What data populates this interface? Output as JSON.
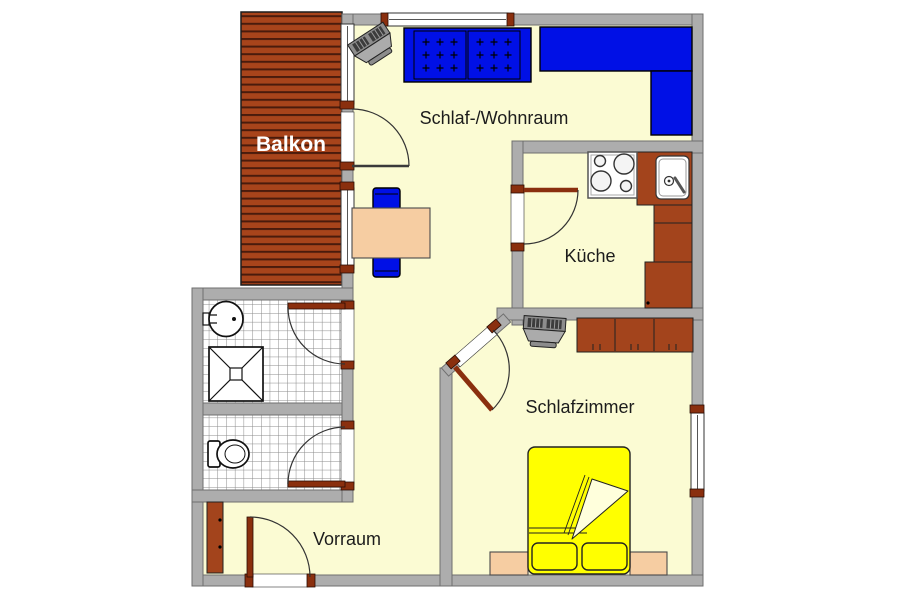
{
  "image_type": "apartment-floor-plan",
  "rooms": {
    "balkon": {
      "label": "Balkon"
    },
    "wohnraum": {
      "label": "Schlaf-/Wohnraum"
    },
    "kueche": {
      "label": "Küche"
    },
    "schlafzimmer": {
      "label": "Schlafzimmer"
    },
    "vorraum": {
      "label": "Vorraum"
    }
  },
  "colors": {
    "background": "#FFFFFF",
    "floor": "#FBFBD3",
    "wall": "#ADADAD",
    "wall_outline": "#6F6F6F",
    "balcony_deck": "#A8441B",
    "balcony_plank_line": "#4A1B0C",
    "furniture_wood": "#A3441C",
    "furniture_blue": "#0010E6",
    "bed_yellow": "#FFFF00",
    "table_peach": "#F6CDA2",
    "tile_grid": "#8A8A8A",
    "door_sill": "#8A2F0E",
    "label_text": "#1C1C1C",
    "balkon_label_text": "#FFFFFF"
  },
  "fixtures": [
    "sofa-bed",
    "corner-sofa",
    "tv",
    "dining-table",
    "chair",
    "stove",
    "kitchen-sink",
    "kitchen-cabinet",
    "wardrobe",
    "double-bed",
    "pillow",
    "nightstand",
    "washbasin",
    "shower",
    "toilet",
    "hall-cabinet",
    "door-swing",
    "window"
  ]
}
